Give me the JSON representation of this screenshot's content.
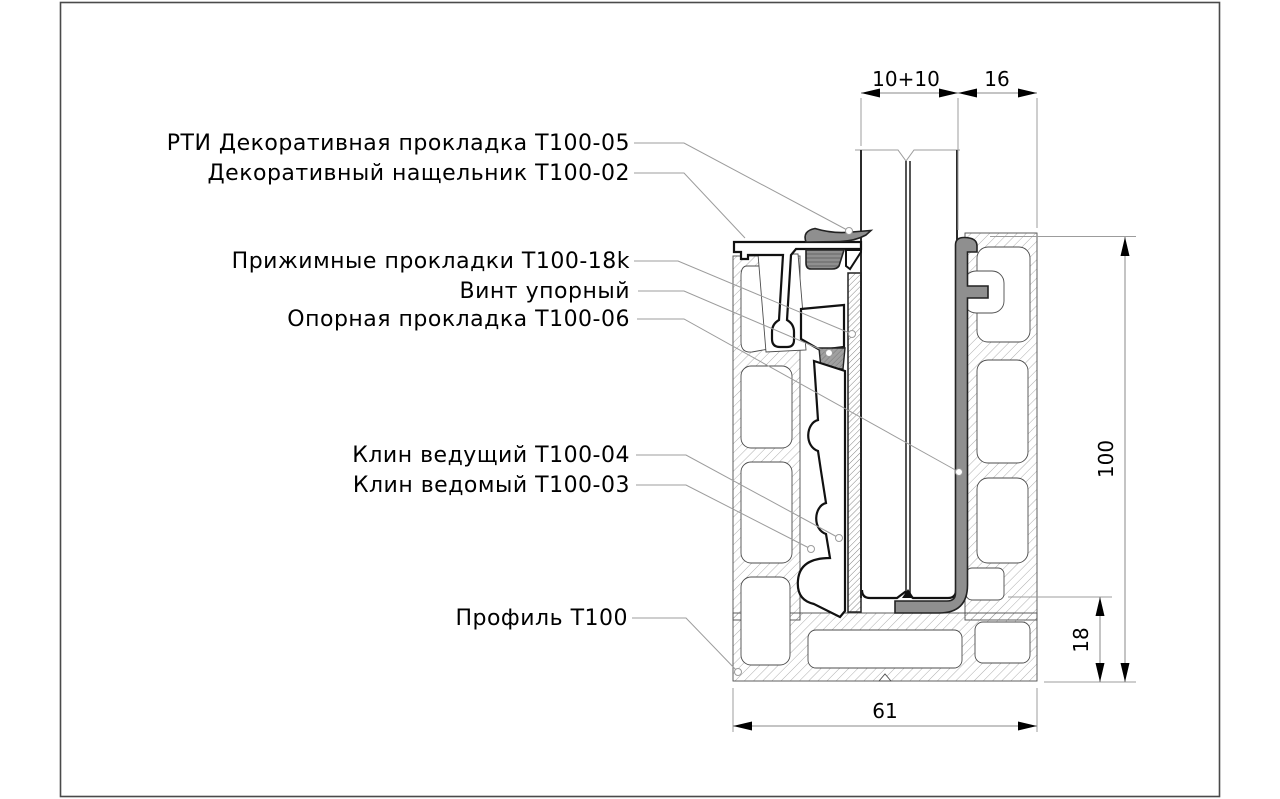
{
  "drawing": {
    "labels": [
      {
        "id": "rti-gasket",
        "text": "РТИ Декоративная прокладка Т100-05"
      },
      {
        "id": "cover-strip",
        "text": "Декоративный нащельник Т100-02"
      },
      {
        "id": "clamp-pads",
        "text": "Прижимные прокладки Т100-18k"
      },
      {
        "id": "stop-screw",
        "text": "Винт упорный"
      },
      {
        "id": "support-gasket",
        "text": "Опорная прокладка Т100-06"
      },
      {
        "id": "driving-wedge",
        "text": "Клин ведущий Т100-04"
      },
      {
        "id": "driven-wedge",
        "text": "Клин ведомый Т100-03"
      },
      {
        "id": "profile",
        "text": "Профиль Т100"
      }
    ],
    "dimensions": {
      "glass_package": "10+10",
      "edge_offset": "16",
      "profile_height": "100",
      "base_offset": "18",
      "profile_width": "61"
    },
    "colors": {
      "outline": "#111111",
      "profile_line": "#4d4d4d",
      "gasket_gray": "#8f8f8f",
      "leader": "#9c9c9c",
      "dimension": "#8a8a8a"
    }
  }
}
